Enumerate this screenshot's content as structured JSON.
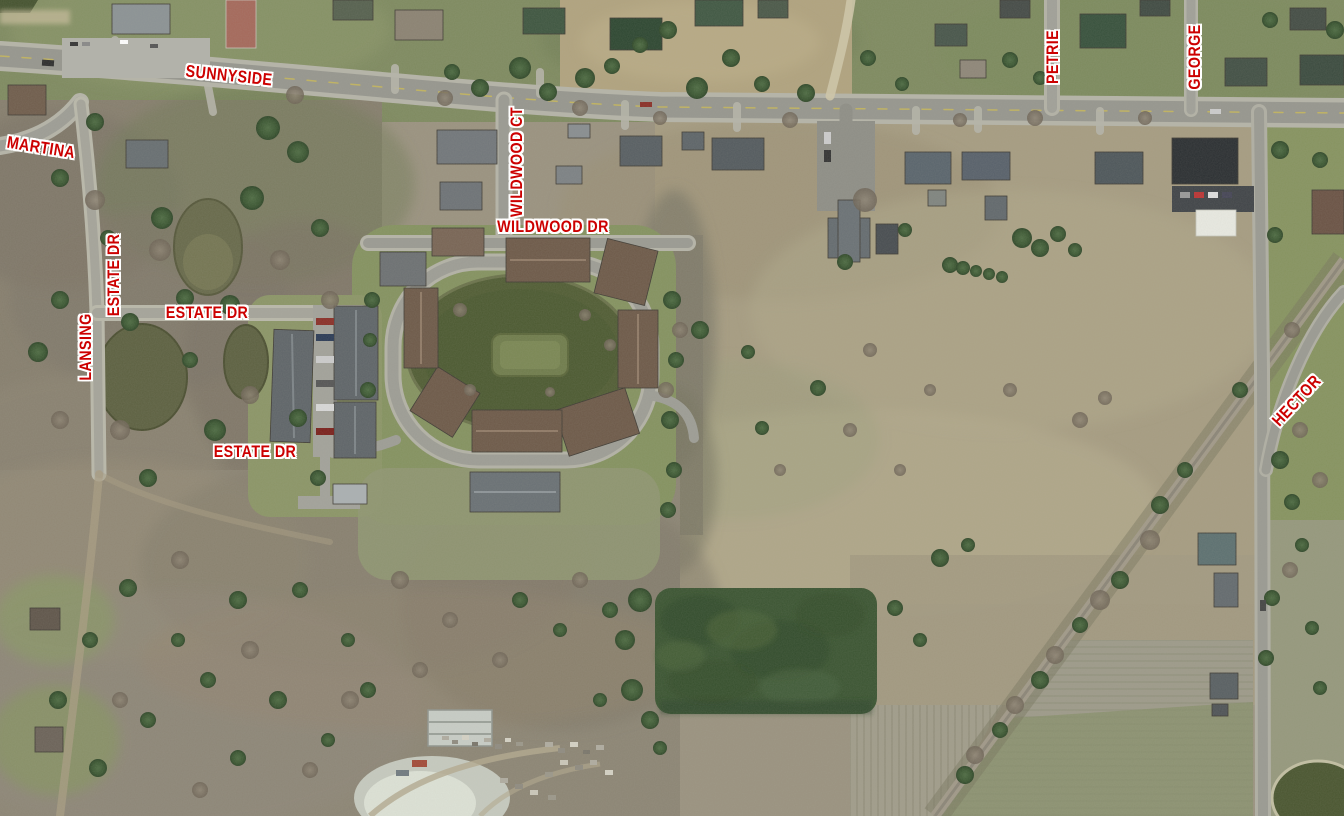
{
  "map": {
    "type": "aerial-orthophoto",
    "label_color": "#cc0000",
    "label_outline_color": "#ffffff",
    "street_labels": [
      {
        "text": "SUNNYSIDE",
        "x": 229,
        "y": 76,
        "rotation": 6
      },
      {
        "text": "MARTINA",
        "x": 41,
        "y": 148,
        "rotation": 9
      },
      {
        "text": "WILDWOOD CT",
        "x": 517,
        "y": 162,
        "rotation": -90
      },
      {
        "text": "WILDWOOD DR",
        "x": 553,
        "y": 227,
        "rotation": 0
      },
      {
        "text": "PETRIE",
        "x": 1053,
        "y": 57,
        "rotation": -90
      },
      {
        "text": "GEORGE",
        "x": 1195,
        "y": 57,
        "rotation": -90
      },
      {
        "text": "ESTATE DR",
        "x": 114,
        "y": 275,
        "rotation": -90
      },
      {
        "text": "LANSING",
        "x": 86,
        "y": 347,
        "rotation": -90
      },
      {
        "text": "ESTATE DR",
        "x": 207,
        "y": 313,
        "rotation": 0
      },
      {
        "text": "ESTATE DR",
        "x": 255,
        "y": 452,
        "rotation": 0
      },
      {
        "text": "HECTOR",
        "x": 1297,
        "y": 401,
        "rotation": -47
      }
    ]
  }
}
